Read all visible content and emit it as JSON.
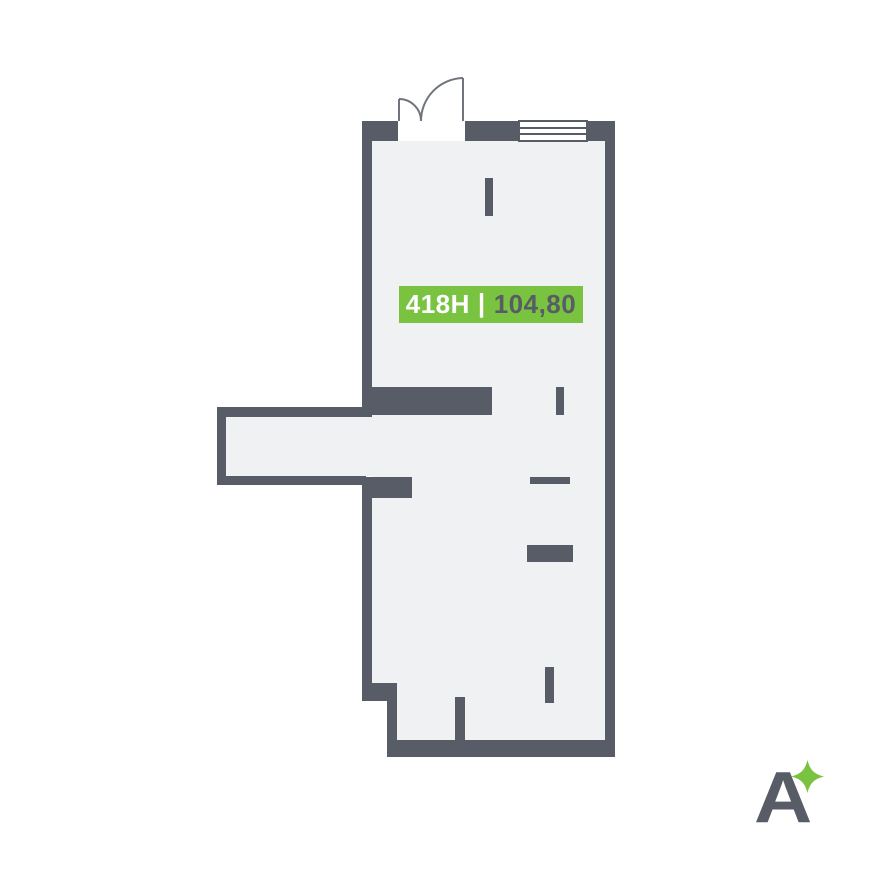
{
  "palette": {
    "background": "#FFFFFF",
    "wall": "#575C66",
    "floor": "#F0F1F2",
    "green": "#79C340",
    "door_stroke": "#70757D",
    "window_bg": "#FFFFFF"
  },
  "unit_label": {
    "code": "418H",
    "separator": "|",
    "area": "104,80",
    "bg": "#79C340",
    "code_color": "#FFFFFF",
    "area_color": "#575C66"
  },
  "logo": {
    "letter": "A",
    "letter_color": "#575C66",
    "star_color": "#79C340"
  },
  "floorplan": {
    "floors": [
      {
        "name": "main-room-floor",
        "points": "372,141 605,141 605,740 397,740 397,683 372,683"
      },
      {
        "name": "corridor-floor",
        "points": "226,417 372,417 372,476 226,476"
      }
    ],
    "walls": [
      {
        "name": "top-wall-left",
        "x": 362,
        "y": 121,
        "w": 36,
        "h": 20
      },
      {
        "name": "top-wall-mid",
        "x": 465,
        "y": 121,
        "w": 54,
        "h": 20
      },
      {
        "name": "top-wall-right",
        "x": 587,
        "y": 121,
        "w": 28,
        "h": 20
      },
      {
        "name": "right-wall",
        "x": 605,
        "y": 121,
        "w": 10,
        "h": 636
      },
      {
        "name": "bottom-wall",
        "x": 387,
        "y": 740,
        "w": 228,
        "h": 17
      },
      {
        "name": "left-wall-upper",
        "x": 362,
        "y": 121,
        "w": 10,
        "h": 296
      },
      {
        "name": "interior-wall-top",
        "x": 366,
        "y": 387,
        "w": 126,
        "h": 28
      },
      {
        "name": "corridor-top-wall",
        "x": 217,
        "y": 407,
        "w": 149,
        "h": 10
      },
      {
        "name": "corridor-left-wall",
        "x": 217,
        "y": 407,
        "w": 9,
        "h": 78
      },
      {
        "name": "corridor-bottom-wall",
        "x": 217,
        "y": 476,
        "w": 149,
        "h": 9
      },
      {
        "name": "interior-stub-left",
        "x": 362,
        "y": 477,
        "w": 50,
        "h": 21
      },
      {
        "name": "left-wall-lower",
        "x": 362,
        "y": 477,
        "w": 10,
        "h": 214
      },
      {
        "name": "step-wall-horizontal",
        "x": 362,
        "y": 683,
        "w": 35,
        "h": 18
      },
      {
        "name": "step-wall-vertical",
        "x": 387,
        "y": 701,
        "w": 10,
        "h": 44
      },
      {
        "name": "partition-stub-top",
        "x": 485,
        "y": 178,
        "w": 8,
        "h": 38
      },
      {
        "name": "partition-stub-mid",
        "x": 556,
        "y": 387,
        "w": 8,
        "h": 28
      },
      {
        "name": "partition-line-mid",
        "x": 530,
        "y": 477,
        "w": 40,
        "h": 7
      },
      {
        "name": "partition-bar-low",
        "x": 527,
        "y": 545,
        "w": 46,
        "h": 17
      },
      {
        "name": "bottom-stub-wall",
        "x": 455,
        "y": 697,
        "w": 10,
        "h": 43
      },
      {
        "name": "floating-stub-wall",
        "x": 545,
        "y": 667,
        "w": 9,
        "h": 36
      }
    ],
    "window": {
      "x": 519,
      "y": 121,
      "w": 68,
      "h": 20,
      "inner_lines_y": [
        128,
        134
      ]
    },
    "door": {
      "leaves": [
        {
          "name": "door-leaf-small",
          "line": "M399,121 L399,99",
          "arc": "M399,99 A22,22 0 0 1 421,121"
        },
        {
          "name": "door-leaf-large",
          "line": "M463,121 L463,78",
          "arc": "M463,78 A43,43 0 0 0 421,121"
        }
      ]
    }
  }
}
